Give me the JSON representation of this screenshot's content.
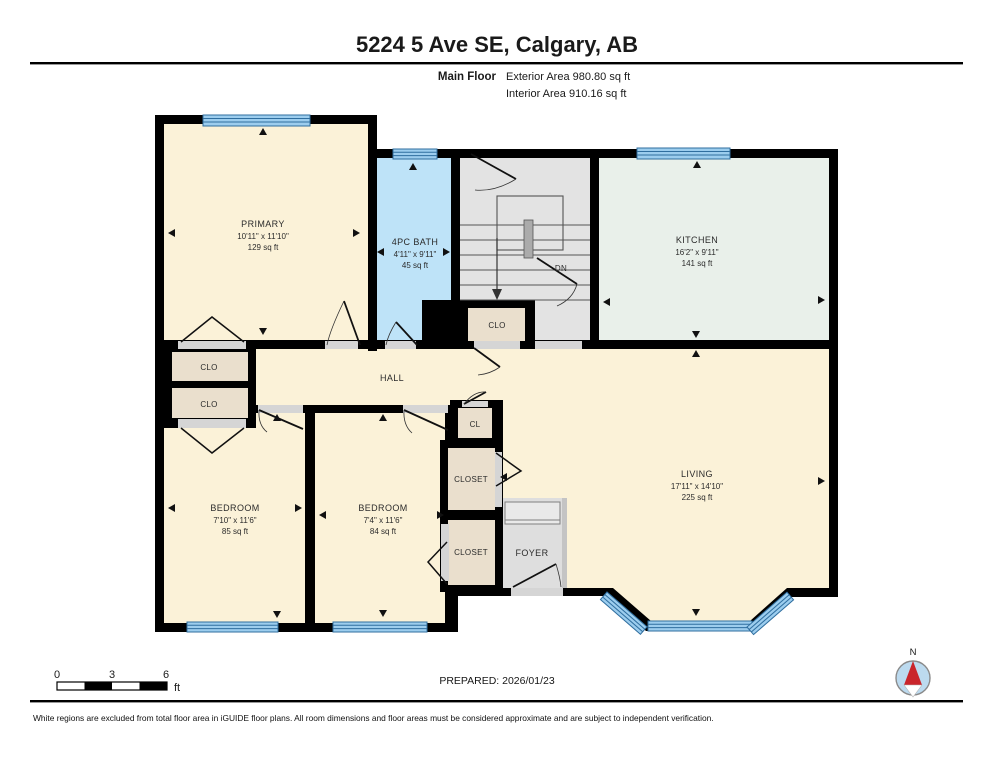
{
  "header": {
    "title": "5224 5 Ave SE, Calgary, AB",
    "floor_label": "Main Floor",
    "exterior_area": "Exterior Area 980.80 sq ft",
    "interior_area": "Interior Area 910.16 sq ft"
  },
  "rooms": {
    "primary": {
      "name": "PRIMARY",
      "dims": "10'11\" x 11'10\"",
      "area": "129 sq ft"
    },
    "bath": {
      "name": "4PC BATH",
      "dims": "4'11\" x 9'11\"",
      "area": "45 sq ft"
    },
    "kitchen": {
      "name": "KITCHEN",
      "dims": "16'2\" x 9'11\"",
      "area": "141 sq ft"
    },
    "living": {
      "name": "LIVING",
      "dims": "17'11\" x 14'10\"",
      "area": "225 sq ft"
    },
    "bedroom1": {
      "name": "BEDROOM",
      "dims": "7'10\" x 11'6\"",
      "area": "85 sq ft"
    },
    "bedroom2": {
      "name": "BEDROOM",
      "dims": "7'4\" x 11'6\"",
      "area": "84 sq ft"
    },
    "hall": {
      "name": "HALL"
    },
    "foyer": {
      "name": "FOYER"
    },
    "closet_primary": {
      "name": "CLO"
    },
    "closet_bedroom1": {
      "name": "CLO"
    },
    "closet_stairs": {
      "name": "CLO"
    },
    "closet_hall": {
      "name": "CL"
    },
    "closet_upper": {
      "name": "CLOSET"
    },
    "closet_lower": {
      "name": "CLOSET"
    },
    "stairs": {
      "down_label": "DN"
    }
  },
  "scale_bar": {
    "tick_0": "0",
    "tick_3": "3",
    "tick_6": "6",
    "unit": "ft"
  },
  "footer": {
    "prepared": "PREPARED: 2026/01/23",
    "disclaimer": "White regions are excluded from total floor area in iGUIDE floor plans. All room dimensions and floor areas must be considered approximate and are subject to independent verification."
  },
  "compass": {
    "north_label": "N"
  },
  "colors": {
    "wall": "#000000",
    "room_cream": "#fbf2d8",
    "bath_blue": "#bee3f8",
    "kitchen_mint": "#e9f0ea",
    "stairs_gray": "#e3e3e3",
    "closet_tan": "#eadfcd",
    "foyer_gray": "#dedede",
    "window_blue": "#9ccdee",
    "window_stroke": "#2f6e9f",
    "compass_red": "#c9252b"
  }
}
